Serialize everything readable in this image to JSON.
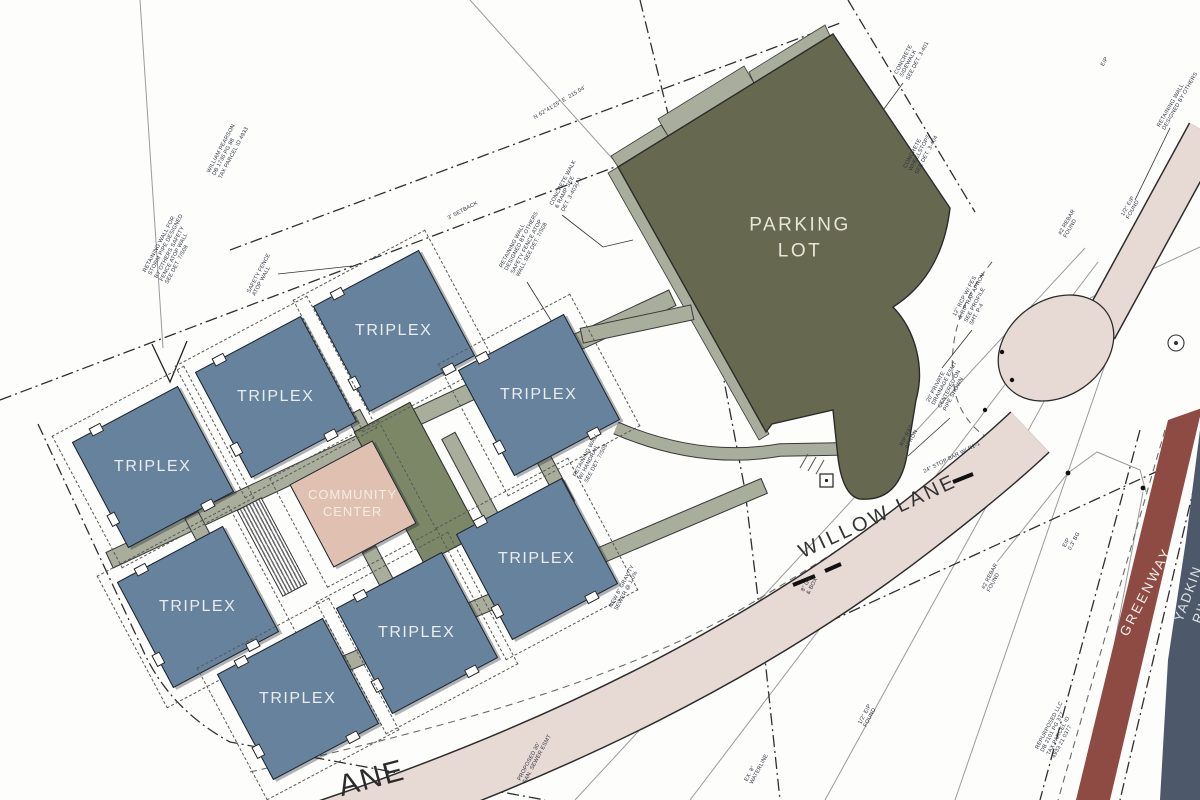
{
  "labels": {
    "triplex": "TRIPLEX",
    "community_center": "COMMUNITY\nCENTER",
    "parking_lot": "PARKING\nLOT",
    "willow_lane": "WILLOW LANE",
    "partial_lane": "ANE",
    "greenway": "GREENWAY",
    "yadkin_river": "YADKIN RIVER"
  },
  "colors": {
    "triplex": "#66829D",
    "community_center": "#DFC0B1",
    "annex": "#7C8768",
    "parking_lot": "#66694F",
    "walkway": "#A9AD9B",
    "road": "#E7D9D3",
    "greenway": "#8E4B43",
    "river": "#4D596A"
  },
  "annotations": [
    {
      "text": "3' SETBACK"
    },
    {
      "text": "N 62°41'25\" E  215.04'"
    },
    {
      "text": "RETAINING WALL FOR\nSTORM PIPE DESIGNED\nBY OTHERS SAFETY\nFENCE ATOP WALL\nSEE DET. 7/S08"
    },
    {
      "text": "SAFETY FENCE\nATOP WALL"
    },
    {
      "text": "WILLIAM PEARSON\nDB 1736 PG 88\nTAX PARCEL ID 4933"
    },
    {
      "text": "RETAINING WALL\nDESIGNED BY OTHERS\nSAFETY FENCE ATOP\nWALL SEE DET. 7/S08"
    },
    {
      "text": "CONCRETE WALK\n& RAMP SEE\nDET. 3-403(A)"
    },
    {
      "text": "CONCRETE\nSIDEWALK\nSEE DET. 3-401"
    },
    {
      "text": "CONCRETE\nWHEELSTOPS\nSEE DET. 3-404"
    },
    {
      "text": "RETAINING WALL\nDESIGNED BY OTHERS"
    },
    {
      "text": "EIP"
    },
    {
      "text": "#2 REBAR\nFOUND"
    },
    {
      "text": "1/2\" EIP\nFOUND"
    },
    {
      "text": "12\" RCP W/ FES\n& RIP RAP APRON\nSEE PROFILE\nSHT. P-4"
    },
    {
      "text": "20' PRIVATE\nDRAINAGE ESMT\nCENTERED ON\nPIPE SHOWN"
    },
    {
      "text": "24\" STOP BAR W/ R1-1"
    },
    {
      "text": "EIP\n0.3' BG"
    },
    {
      "text": "#2 REBAR\nFOUND"
    },
    {
      "text": "RIP RAP\nAPRON"
    },
    {
      "text": "1/2\" EIP\nFOUND"
    },
    {
      "text": "EX. 8\"\nWATERLINE"
    },
    {
      "text": "REPURPOSED LLC\nDB 2101 PG 377\nTAX PARCEL ID\n4933 21 0377"
    },
    {
      "text": "RETAINING WALL\nW/ HANDRAIL\nSEE DET. 7/S08"
    },
    {
      "text": "NEW 8\" GRAVITY\nSEWER @ 1.0%"
    },
    {
      "text": "PROPOSED 30'\nSAN. SEWER ESMT"
    },
    {
      "text": "8\" GV\n& BOX"
    }
  ]
}
